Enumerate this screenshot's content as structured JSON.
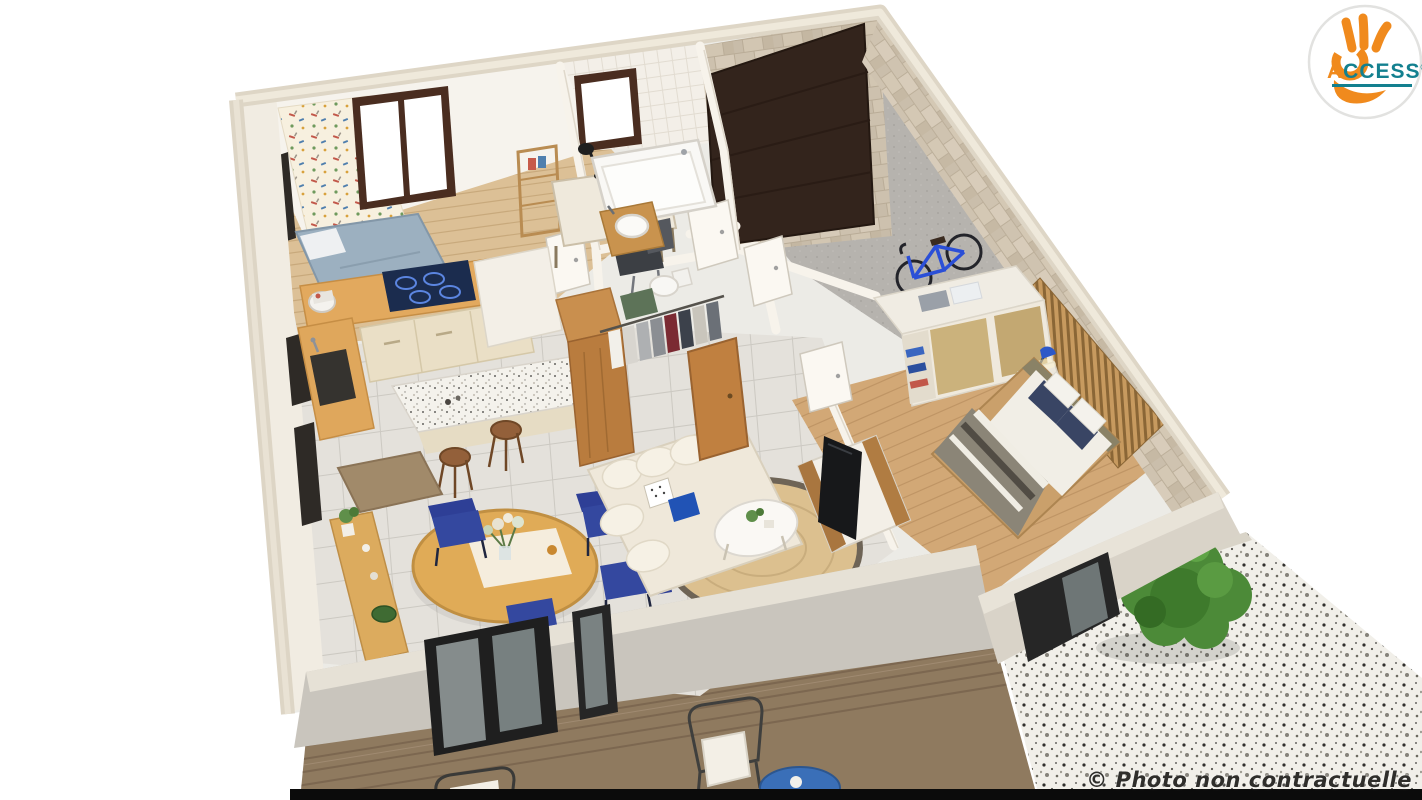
{
  "page": {
    "background": "#FFFFFF",
    "bottom_bar_color": "#0B0B0B"
  },
  "logo": {
    "brand": "ACCESS",
    "text_a": "A",
    "text_rest": "CCESS",
    "mark": "®",
    "icon": "ok-hand-icon"
  },
  "footer": {
    "copyright": "© Photo non contractuelle"
  },
  "palette": {
    "logo_orange": "#F08A1D",
    "logo_teal": "#13808F",
    "wall_cream": "#F2EDE3",
    "wall_cap": "#DED6C6",
    "stone_beige": "#CDC1AE",
    "garage_door_brown": "#33241C",
    "garage_floor_gray": "#B6B3AE",
    "wood_counter": "#E2A95E",
    "cooktop_navy": "#1B2C4E",
    "cabinet_cream": "#EADFC6",
    "dining_table_wood": "#E0AB57",
    "chair_blue": "#2E3F96",
    "sofa_cream": "#EFE8DA",
    "pillow_blue": "#2153B5",
    "rug_jute": "#DCC08F",
    "tv_dark": "#17181A",
    "duvet_gray": "#8B8577",
    "pillow_navy": "#394564",
    "slat_wood": "#C79A5F",
    "bike_blue": "#2B4FD7",
    "lamp_blue": "#2D58C8",
    "deck_wood": "#8F7A5F",
    "bush_green": "#4C8A38",
    "terrazzo_base": "#F1EFE9"
  },
  "scene": {
    "description": "3D isometric cutaway floor-plan render of a single-storey home",
    "rooms": [
      {
        "name": "kids-bedroom",
        "objects": [
          "patterned-wallpaper",
          "window",
          "single-bed",
          "desk",
          "desk-lamp",
          "desk-chair",
          "shelf"
        ]
      },
      {
        "name": "bathroom",
        "objects": [
          "window",
          "bathtub",
          "vessel-sink",
          "toilet",
          "bath-mat"
        ]
      },
      {
        "name": "garage",
        "objects": [
          "garage-door",
          "stone-wall",
          "concrete-floor",
          "bicycle"
        ]
      },
      {
        "name": "kitchen",
        "objects": [
          "induction-hob",
          "stand-mixer",
          "sink",
          "cream-cabinets",
          "terrazzo-island",
          "bar-stools",
          "doormat",
          "tall-cabinet"
        ]
      },
      {
        "name": "dining-area",
        "objects": [
          "round-table",
          "flower-centerpiece",
          "blue-chairs",
          "wood-bench",
          "plants"
        ]
      },
      {
        "name": "living-room",
        "objects": [
          "corner-sofa",
          "cushions",
          "jute-rug",
          "coffee-table",
          "tv-stand",
          "tv"
        ]
      },
      {
        "name": "walk-in-closet",
        "objects": [
          "wood-wardrobe",
          "clothes-rail",
          "hanging-clothes",
          "wood-door"
        ]
      },
      {
        "name": "master-bedroom",
        "objects": [
          "double-bed",
          "striped-duvet",
          "navy-pillows",
          "slat-headboard-wall",
          "nightstand",
          "blue-lamp",
          "white-wardrobe",
          "folded-towels"
        ]
      }
    ],
    "exterior": [
      "wood-deck",
      "outdoor-wire-chair",
      "outdoor-blue-table",
      "terrazzo-patio",
      "green-bush",
      "sliding-glass-doors"
    ]
  }
}
